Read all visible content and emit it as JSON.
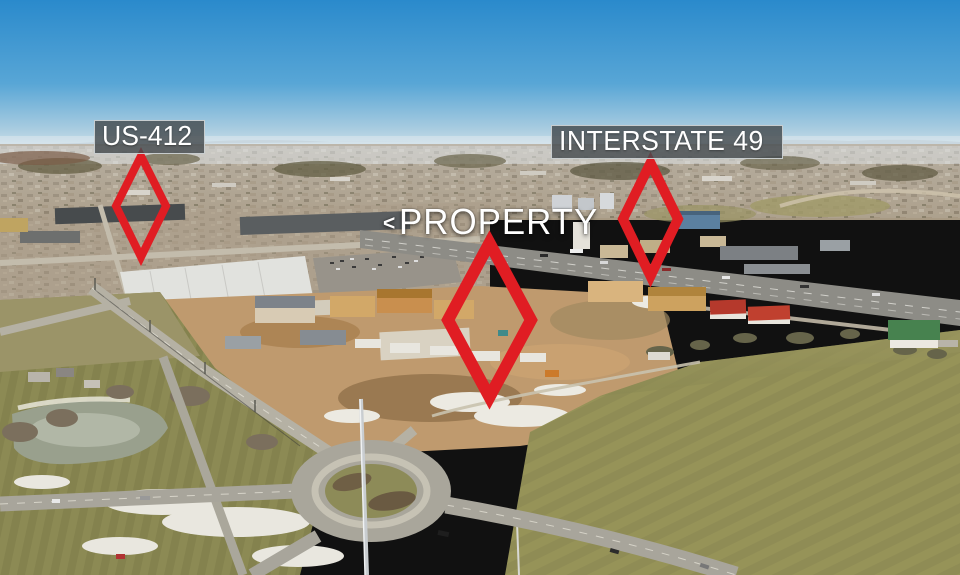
{
  "meta": {
    "type": "aerial-drone-photograph",
    "subject": "Aerial view of a development property between US-412 and Interstate 49"
  },
  "annotations": {
    "marker_color": "#e01d23",
    "label_box_bg": "rgba(68,74,78,0.82)",
    "label_box_border": "rgba(228,232,234,0.8)",
    "label_text_color": "#ffffff",
    "labels": {
      "us412": {
        "text": "US-412"
      },
      "property": {
        "prefix": "<",
        "text": "PROPERTY"
      },
      "interstate49": {
        "text": "INTERSTATE 49"
      }
    }
  }
}
